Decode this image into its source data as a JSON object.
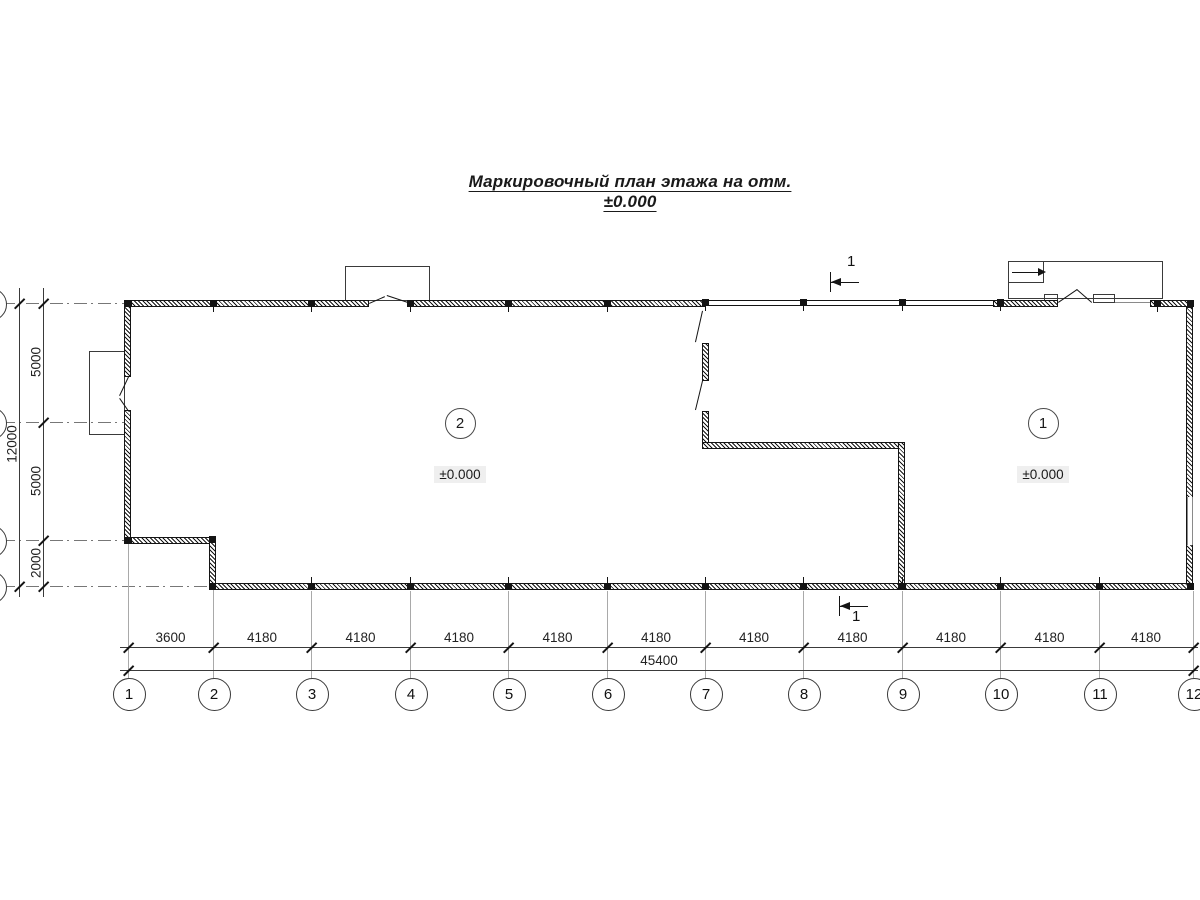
{
  "title": "Маркировочный план этажа на отм. ±0.000",
  "section": {
    "label": "1"
  },
  "rooms": [
    {
      "number": "2",
      "elevation": "±0.000"
    },
    {
      "number": "1",
      "elevation": "±0.000"
    }
  ],
  "grid": {
    "columns": [
      "1",
      "2",
      "3",
      "4",
      "5",
      "6",
      "7",
      "8",
      "9",
      "10",
      "11",
      "12"
    ],
    "column_spacings": [
      "3600",
      "4180",
      "4180",
      "4180",
      "4180",
      "4180",
      "4180",
      "4180",
      "4180",
      "4180",
      "4180"
    ],
    "total_width": "45400",
    "row_spacings": [
      "5000",
      "5000",
      "2000"
    ],
    "total_height": "12000"
  }
}
